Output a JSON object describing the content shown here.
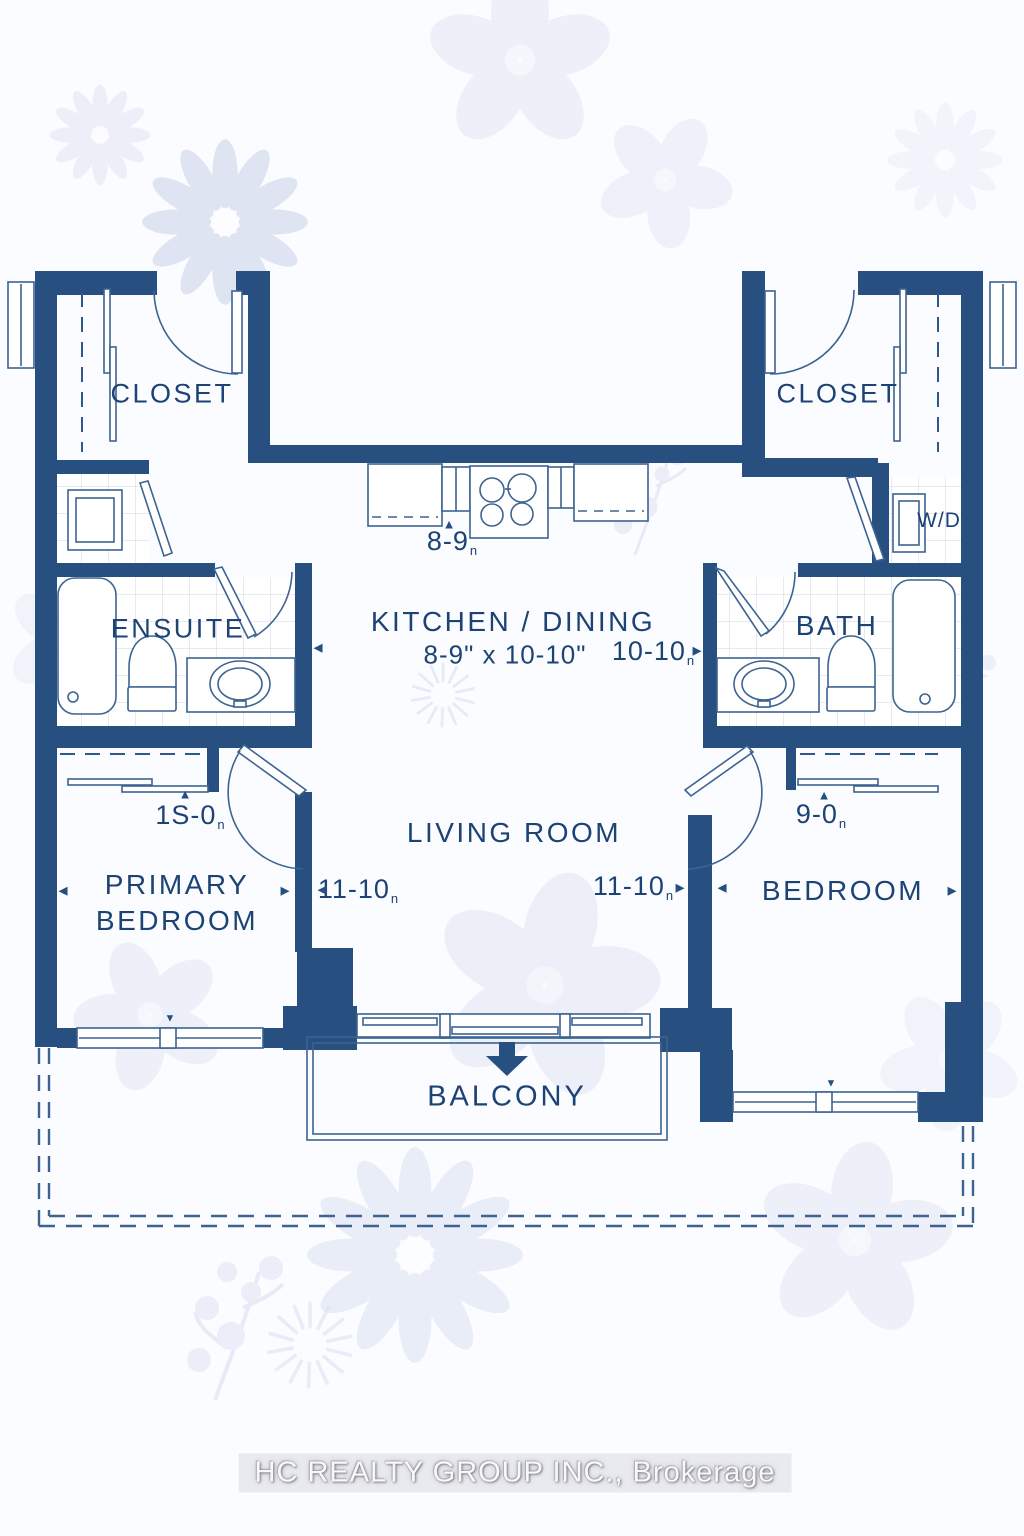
{
  "page": {
    "type": "Residential condo floor plan"
  },
  "colors": {
    "wall": "#275081",
    "line": "#3d6391",
    "text": "#1d4274",
    "tile": "#ccd6e8",
    "floral": "#dadff2",
    "background": "#fbfcff"
  },
  "rooms": {
    "closet_left": {
      "label": "CLOSET"
    },
    "closet_right": {
      "label": "CLOSET"
    },
    "kitchen": {
      "label": "KITCHEN / DINING",
      "size": "8-9\" x 10-10\""
    },
    "ensuite": {
      "label": "ENSUITE"
    },
    "bath": {
      "label": "BATH"
    },
    "laundry": {
      "label": "W/D"
    },
    "living": {
      "label": "LIVING ROOM"
    },
    "primary_bedroom": {
      "label": "PRIMARY BEDROOM"
    },
    "bedroom": {
      "label": "BEDROOM"
    },
    "balcony": {
      "label": "BALCONY"
    }
  },
  "dimensions": {
    "kitchen_width": "8-9",
    "kitchen_depth": "10-10",
    "living_left": "11-10",
    "living_right": "11-10",
    "primary_closet": "1S-0",
    "bedroom_closet": "9-0",
    "unit_mark": "n"
  },
  "icons": {
    "arrow_left": "◄",
    "arrow_right": "►",
    "arrow_up": "▲",
    "arrow_down": "▼",
    "balcony_entry": "down-arrow"
  },
  "watermark": {
    "text": "HC REALTY GROUP INC., Brokerage"
  }
}
